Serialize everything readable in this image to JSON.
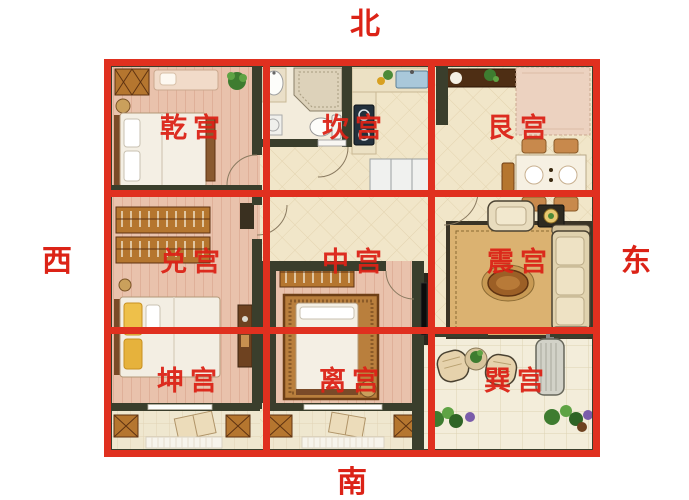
{
  "compass": {
    "north": "北",
    "south": "南",
    "west": "西",
    "east": "东"
  },
  "palaces": [
    {
      "id": "qian",
      "label": "乾宫",
      "position": "northwest"
    },
    {
      "id": "kan",
      "label": "坎宫",
      "position": "north"
    },
    {
      "id": "gen",
      "label": "艮宫",
      "position": "northeast"
    },
    {
      "id": "dui",
      "label": "兑宫",
      "position": "west"
    },
    {
      "id": "zhong",
      "label": "中宫",
      "position": "center"
    },
    {
      "id": "zhen",
      "label": "震宫",
      "position": "east"
    },
    {
      "id": "kun",
      "label": "坤宫",
      "position": "southwest"
    },
    {
      "id": "li",
      "label": "离宫",
      "position": "south"
    },
    {
      "id": "xun",
      "label": "巽宫",
      "position": "southeast"
    }
  ],
  "colors": {
    "grid_red": "#e0301f",
    "label_red": "#dc2317",
    "wall": "#3a3e2c",
    "floor_cream": "#f1e6c9",
    "floor_pink": "#e9c2ac",
    "furn_orange": "#b5762f",
    "page_bg": "#ffffff"
  }
}
